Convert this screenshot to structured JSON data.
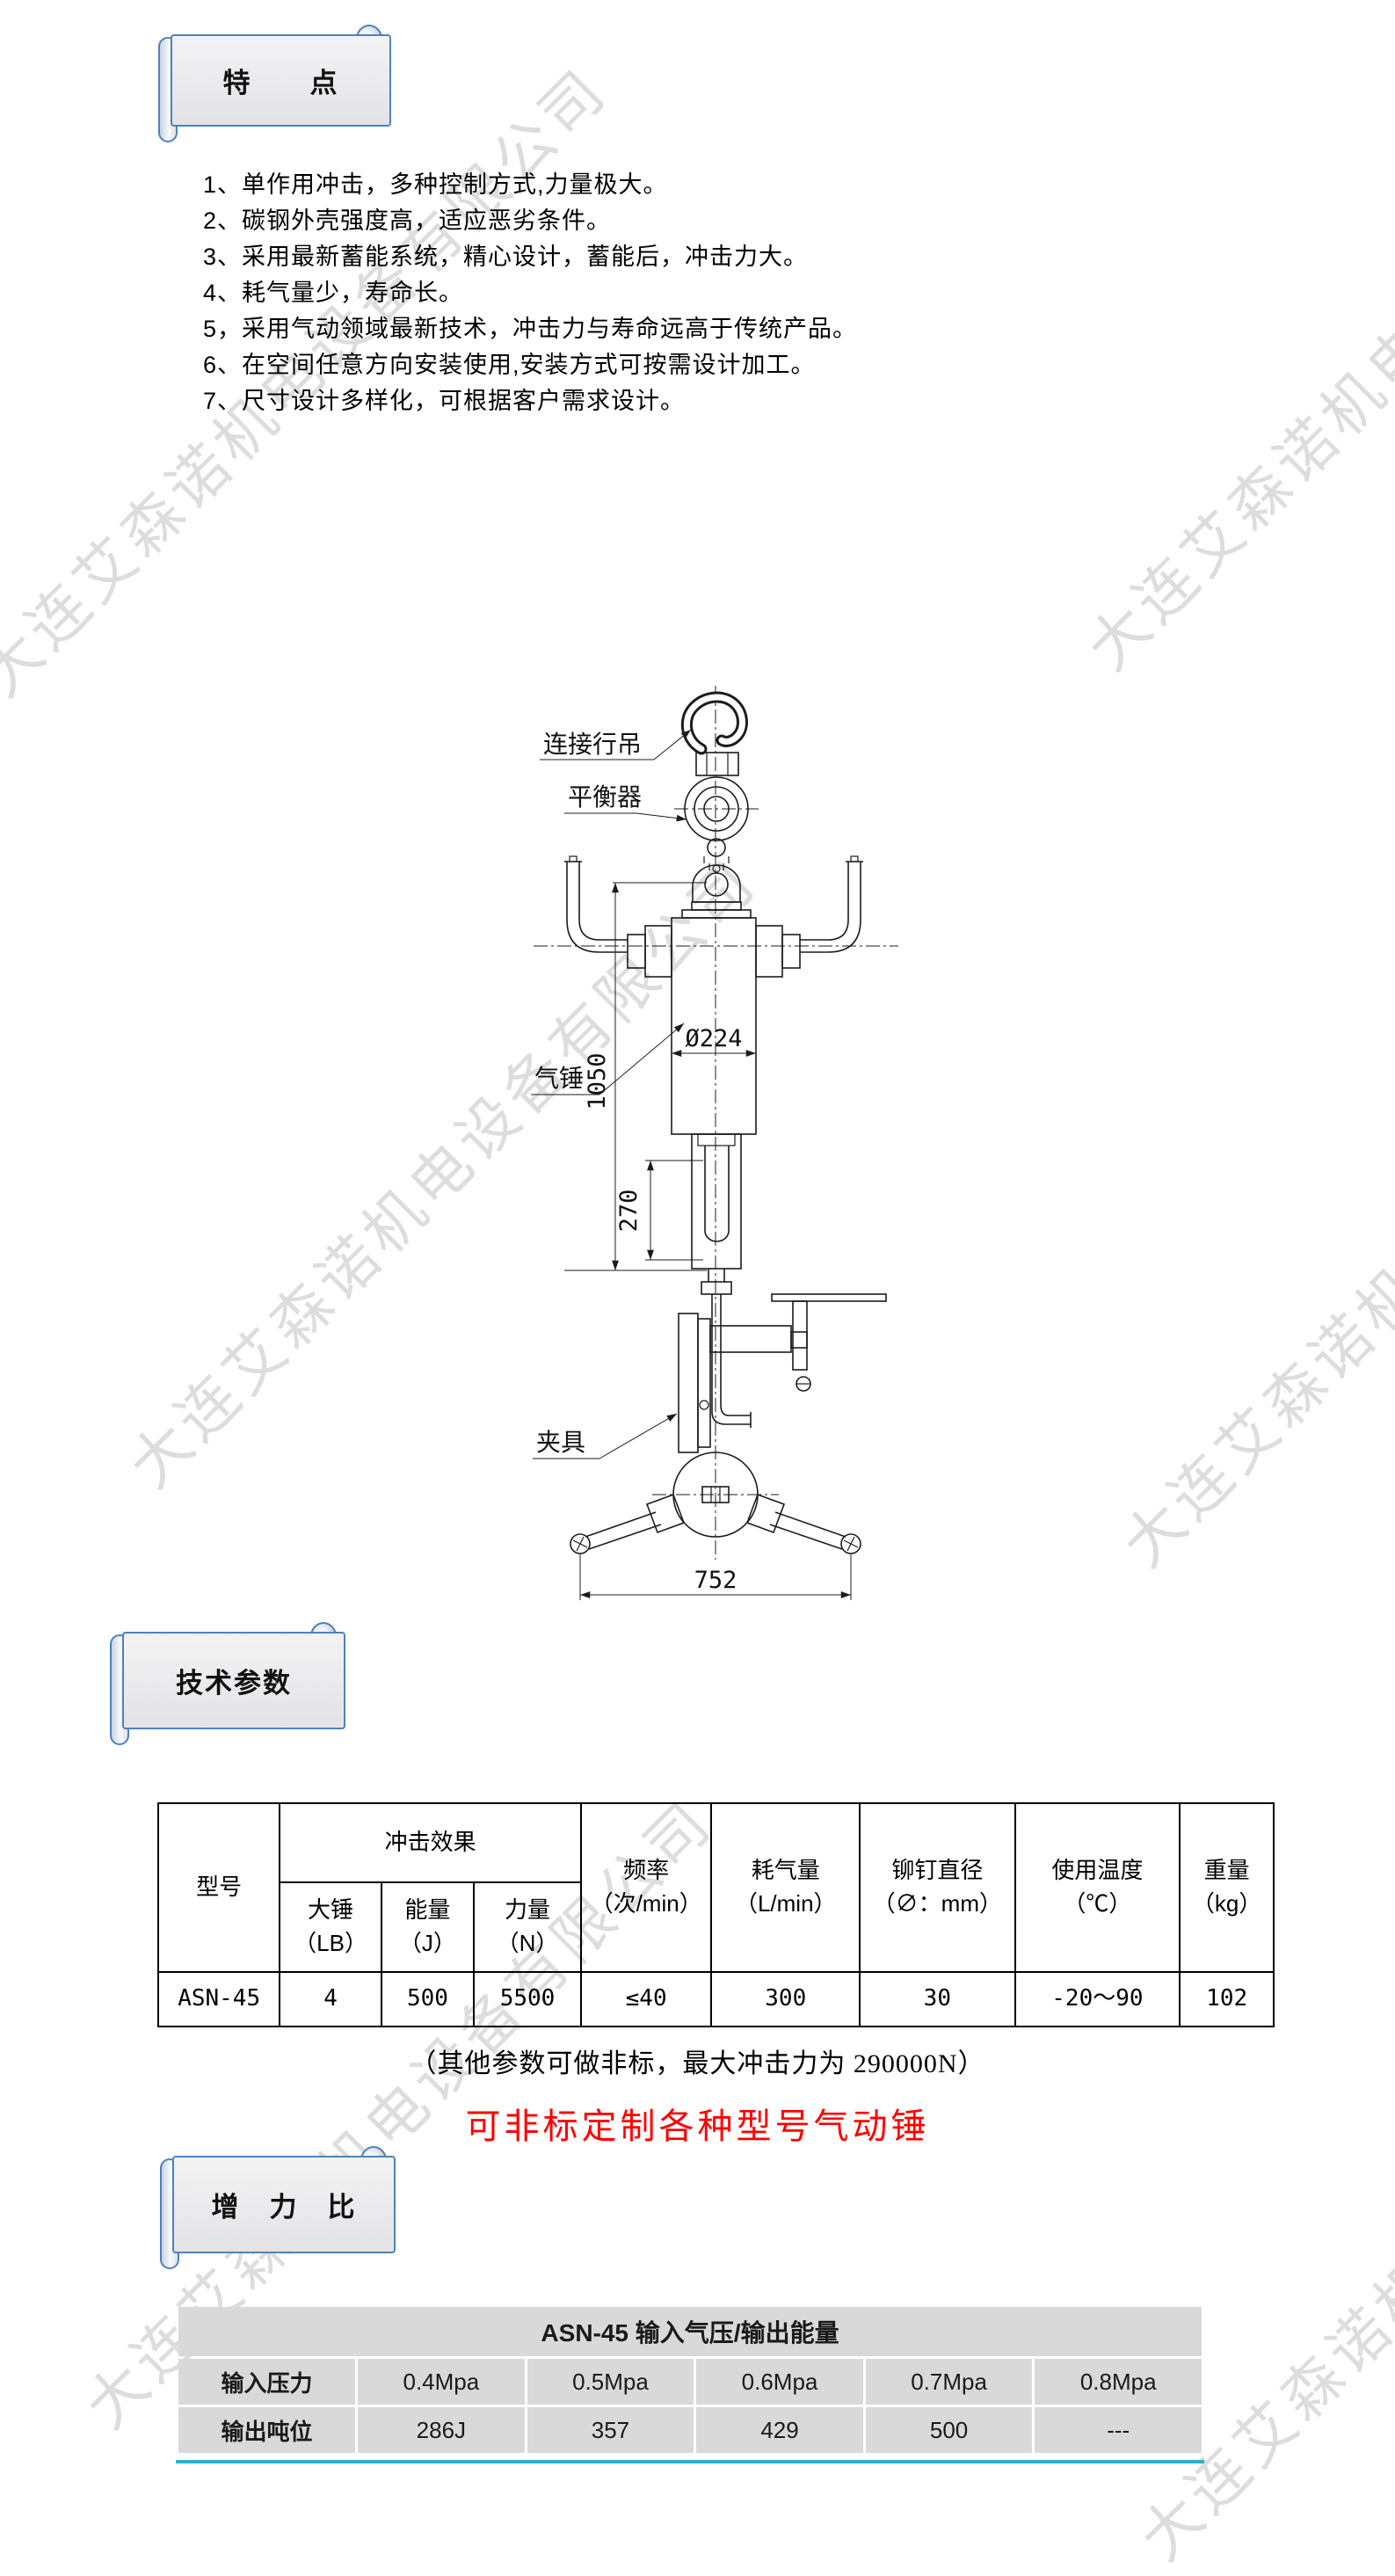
{
  "watermark": {
    "text": "大连艾森诺机电设备有限公司",
    "color": "#bdbdbd",
    "positions": [
      [
        330,
        430
      ],
      [
        1590,
        400
      ],
      [
        500,
        1330
      ],
      [
        1630,
        1420
      ],
      [
        450,
        2400
      ],
      [
        1650,
        2550
      ]
    ]
  },
  "banners": {
    "features": "特　　点",
    "specs": "技术参数",
    "ratio": "增　力　比"
  },
  "features": {
    "items": [
      "1、单作用冲击，多种控制方式,力量极大。",
      "2、碳钢外壳强度高，适应恶劣条件。",
      "3、采用最新蓄能系统，精心设计，蓄能后，冲击力大。",
      "4、耗气量少，寿命长。",
      "5，采用气动领域最新技术，冲击力与寿命远高于传统产品。",
      "6、在空间任意方向安装使用,安装方式可按需设计加工。",
      "7、尺寸设计多样化，可根据客户需求设计。"
    ]
  },
  "drawing": {
    "labels": {
      "hook": "连接行吊",
      "balancer": "平衡器",
      "hammer": "气锤",
      "clamp": "夹具"
    },
    "dimensions": {
      "overall_height": "1050",
      "stroke": "270",
      "diameter": "Ø224",
      "handle_span": "752"
    }
  },
  "spec_table": {
    "headers": {
      "model": "型号",
      "impact_group": "冲击效果",
      "hammer": "大锤",
      "hammer_unit": "（LB）",
      "energy": "能量",
      "energy_unit": "（J）",
      "force": "力量",
      "force_unit": "（N）",
      "frequency": "频率",
      "frequency_unit": "（次/min）",
      "air": "耗气量",
      "air_unit": "（L/min）",
      "rivet": "铆钉直径",
      "rivet_unit": "（∅：mm）",
      "temp": "使用温度",
      "temp_unit": "（℃）",
      "weight": "重量",
      "weight_unit": "（kg）"
    },
    "row": [
      "ASN-45",
      "4",
      "500",
      "5500",
      "≤40",
      "300",
      "30",
      "-20～90",
      "102"
    ]
  },
  "notes": {
    "nonstandard": "（其他参数可做非标，最大冲击力为 290000N）",
    "custom_red": "可非标定制各种型号气动锤"
  },
  "ratio_table": {
    "title": "ASN-45 输入气压/输出能量",
    "rows": [
      {
        "label": "输入压力",
        "values": [
          "0.4Mpa",
          "0.5Mpa",
          "0.6Mpa",
          "0.7Mpa",
          "0.8Mpa"
        ]
      },
      {
        "label": "输出吨位",
        "values": [
          "286J",
          "357",
          "429",
          "500",
          "---"
        ]
      }
    ]
  },
  "colors": {
    "banner_border": "#4f81bd",
    "ratio_cell": "#d9d9d9",
    "ratio_accent": "#2ab3c9",
    "red": "#ff0000",
    "line": "#1c1c1c",
    "watermark": "#bdbdbd"
  }
}
